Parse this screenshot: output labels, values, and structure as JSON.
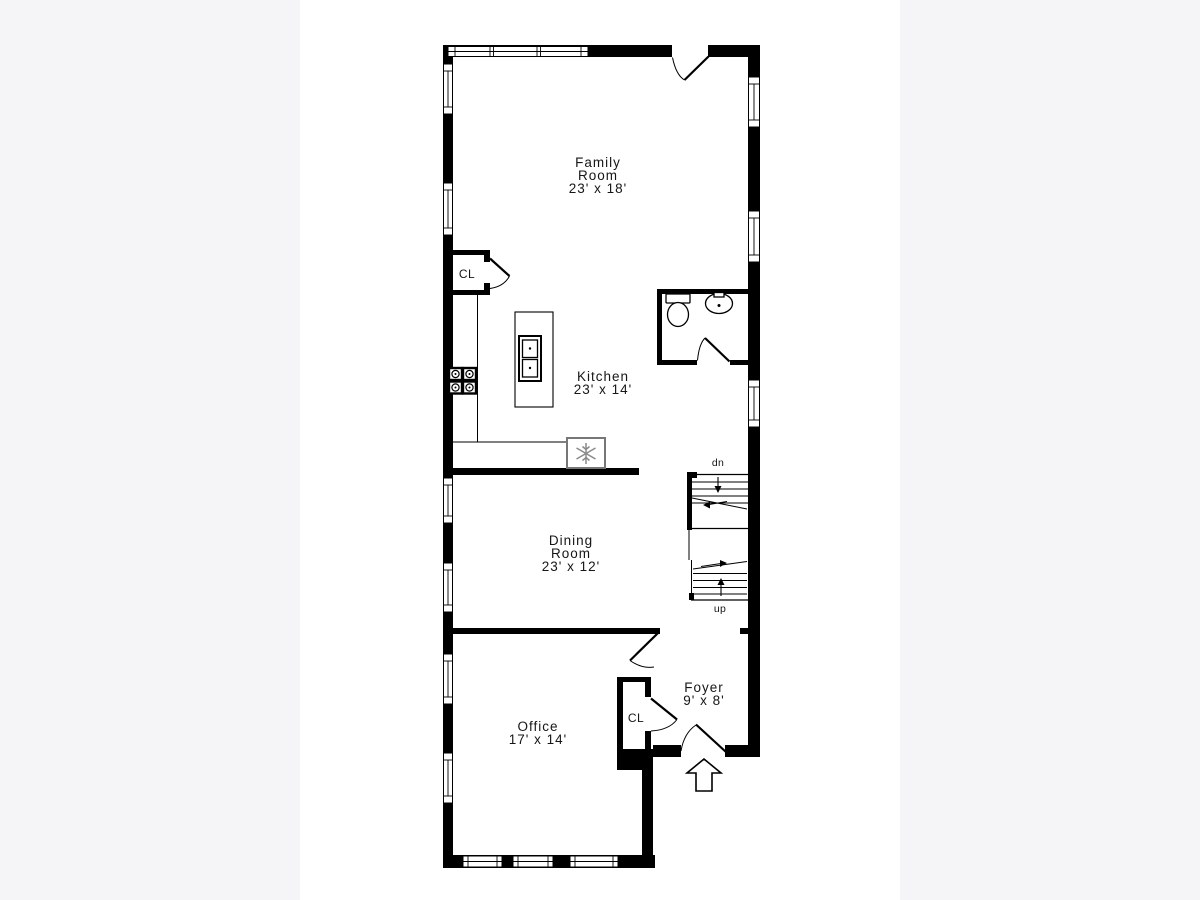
{
  "page": {
    "margin_color": "#f5f4f6",
    "canvas_color": "#ffffff",
    "ink_color": "#000000",
    "fixture_gray": "#8a8a8a"
  },
  "floor_plan": {
    "rooms": {
      "family": {
        "name_line1": "Family",
        "name_line2": "Room",
        "dims": "23' x 18'"
      },
      "kitchen": {
        "name_line1": "Kitchen",
        "dims": "23' x 14'"
      },
      "dining": {
        "name_line1": "Dining",
        "name_line2": "Room",
        "dims": "23' x 12'"
      },
      "office": {
        "name_line1": "Office",
        "dims": "17' x 14'"
      },
      "foyer": {
        "name_line1": "Foyer",
        "dims": "9' x 8'"
      }
    },
    "closets": {
      "kitchen_closet": "CL",
      "foyer_closet": "CL"
    },
    "stairs": {
      "down_label": "dn",
      "up_label": "up"
    }
  }
}
